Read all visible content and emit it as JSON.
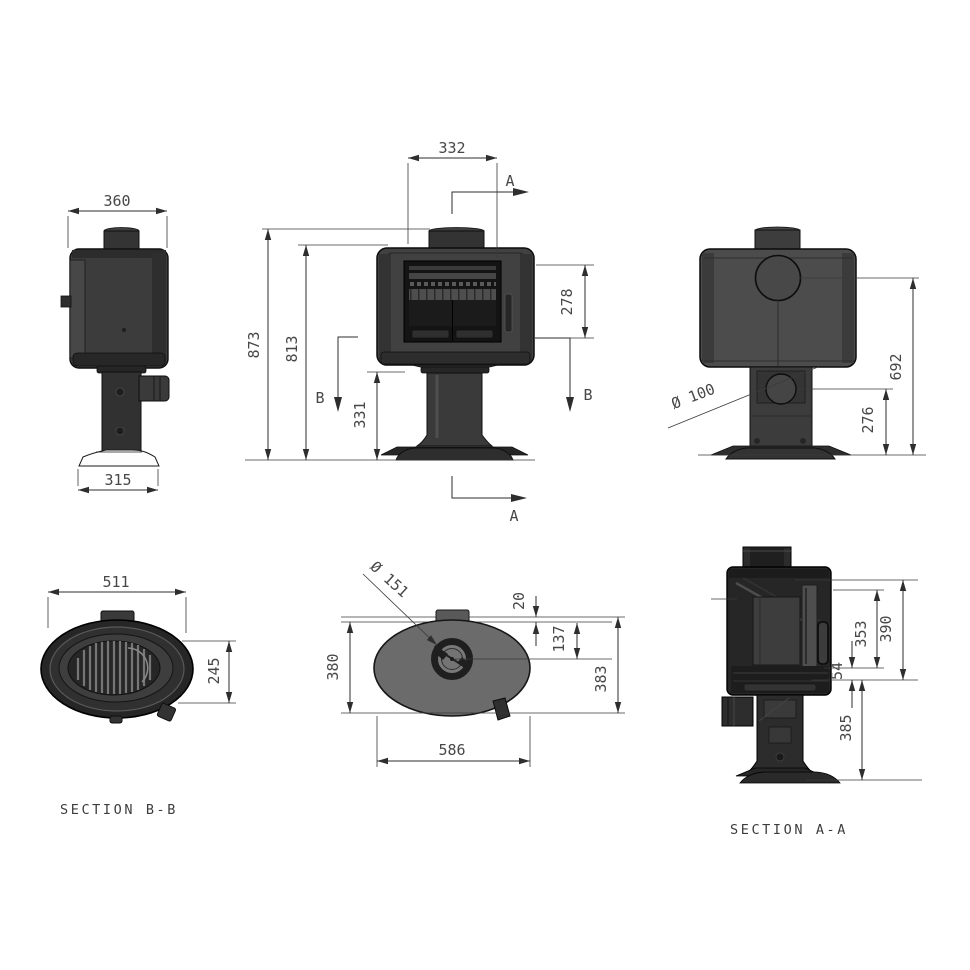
{
  "drawing": {
    "background": "#ffffff",
    "line_color": "#2e2e2e",
    "text_color": "#474747",
    "body_fill": "#414141"
  },
  "views": {
    "side": {
      "top_width": "360",
      "base_width": "315"
    },
    "front": {
      "flue_width": "332",
      "total_height": "873",
      "body_height": "813",
      "glass_height": "278",
      "pedestal_height": "331",
      "cut_a": "A",
      "cut_b": "B"
    },
    "rear": {
      "inlet_diameter": "Ø 100",
      "flue_height": "692",
      "inlet_height": "276"
    },
    "section_bb": {
      "title": "SECTION B-B",
      "width": "511",
      "depth": "245"
    },
    "top": {
      "flue_diameter": "Ø 151",
      "body_depth": "380",
      "collar_offset": "20",
      "flue_offset": "137",
      "total_depth": "383",
      "width": "586"
    },
    "section_aa": {
      "title": "SECTION A-A",
      "dim_firebox": "353",
      "dim_top": "390",
      "dim_gap": "54",
      "dim_pedestal": "385"
    }
  }
}
